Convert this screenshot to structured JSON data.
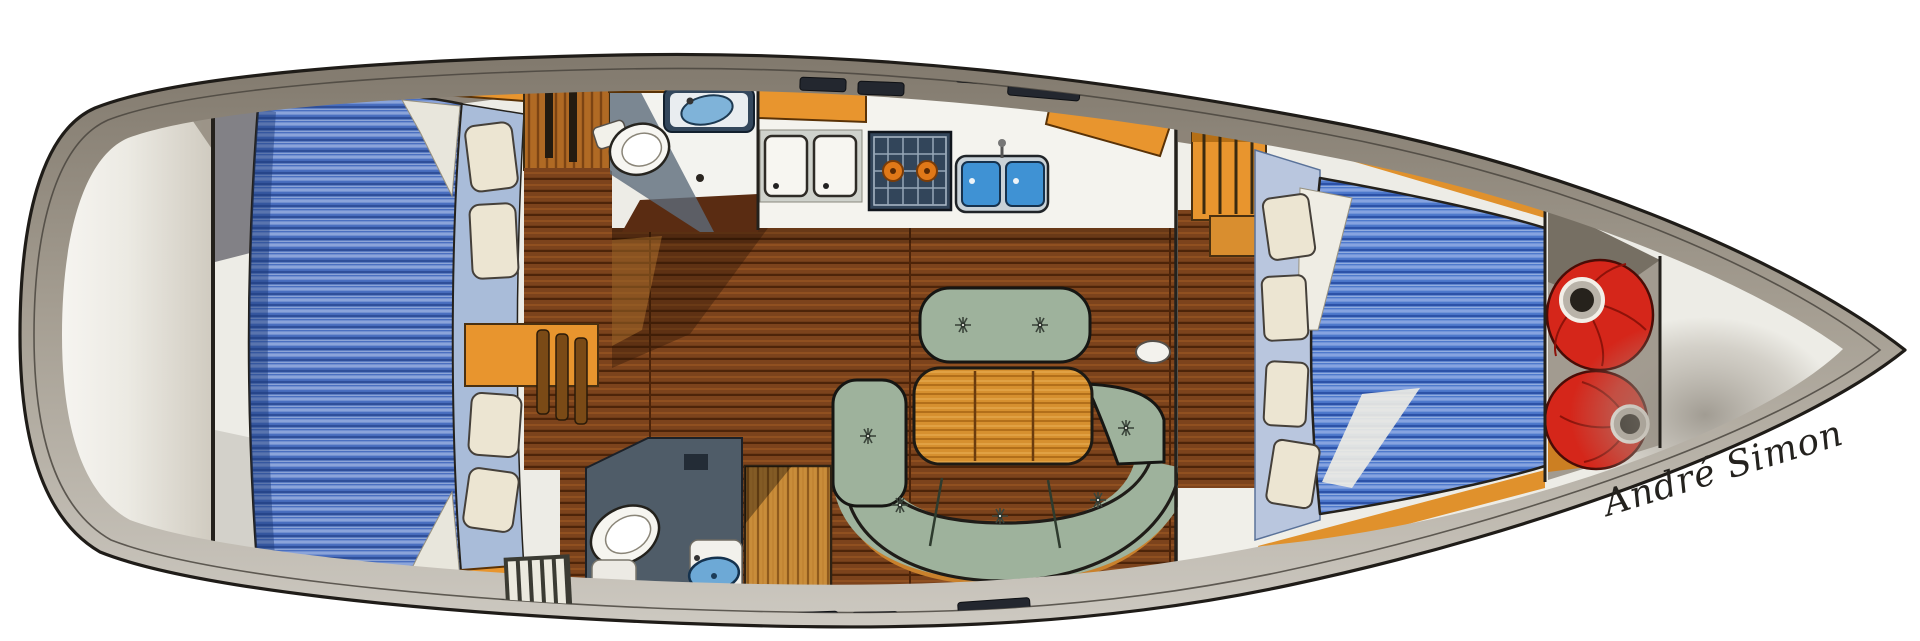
{
  "artwork": {
    "type": "yacht-interior-floor-plan",
    "orientation": "bow-right",
    "signature": "André Simon"
  },
  "palette": {
    "background": "#ffffff",
    "hull_outline": "#1f1c18",
    "deck_dark": "#81796d",
    "deck_mid": "#a59e92",
    "deck_light": "#cdc9c1",
    "interior_base": "#edece6",
    "berth_blue": "#4a6fc0",
    "berth_blue_fwd": "#4e79cc",
    "berth_stripe_light": "#8ba4da",
    "berth_stripe_dark": "#2f4f9a",
    "berth_frame_blue": "#a9bcd9",
    "pillow_cream": "#ece5d2",
    "floor_plank": "#7c431c",
    "floor_seam": "#4d2409",
    "cabinet_orange": "#e8952e",
    "trim_orange": "#c9812c",
    "table_orange": "#d6902f",
    "sofa_green": "#9eb29c",
    "counter_white": "#f4f3ee",
    "wet_navy": "#33475c",
    "slate_gray": "#4f5c68",
    "sink_blue": "#3f92d4",
    "basin_light": "#7fb3d9",
    "stove_navy": "#32455a",
    "burner_orange": "#e07818",
    "bag_red": "#d5261a",
    "wardrobe_wood": "#c98d3a"
  },
  "legend": [
    {
      "name": "cockpit-stern-deck"
    },
    {
      "name": "aft-transverse-berth"
    },
    {
      "name": "companionway"
    },
    {
      "name": "aft-head-toilet-sink"
    },
    {
      "name": "galley-stove-sinks-fridge"
    },
    {
      "name": "saloon-dinette"
    },
    {
      "name": "day-head"
    },
    {
      "name": "wardrobe"
    },
    {
      "name": "forward-v-berth"
    },
    {
      "name": "sail-locker-red-bags"
    },
    {
      "name": "bow"
    }
  ]
}
